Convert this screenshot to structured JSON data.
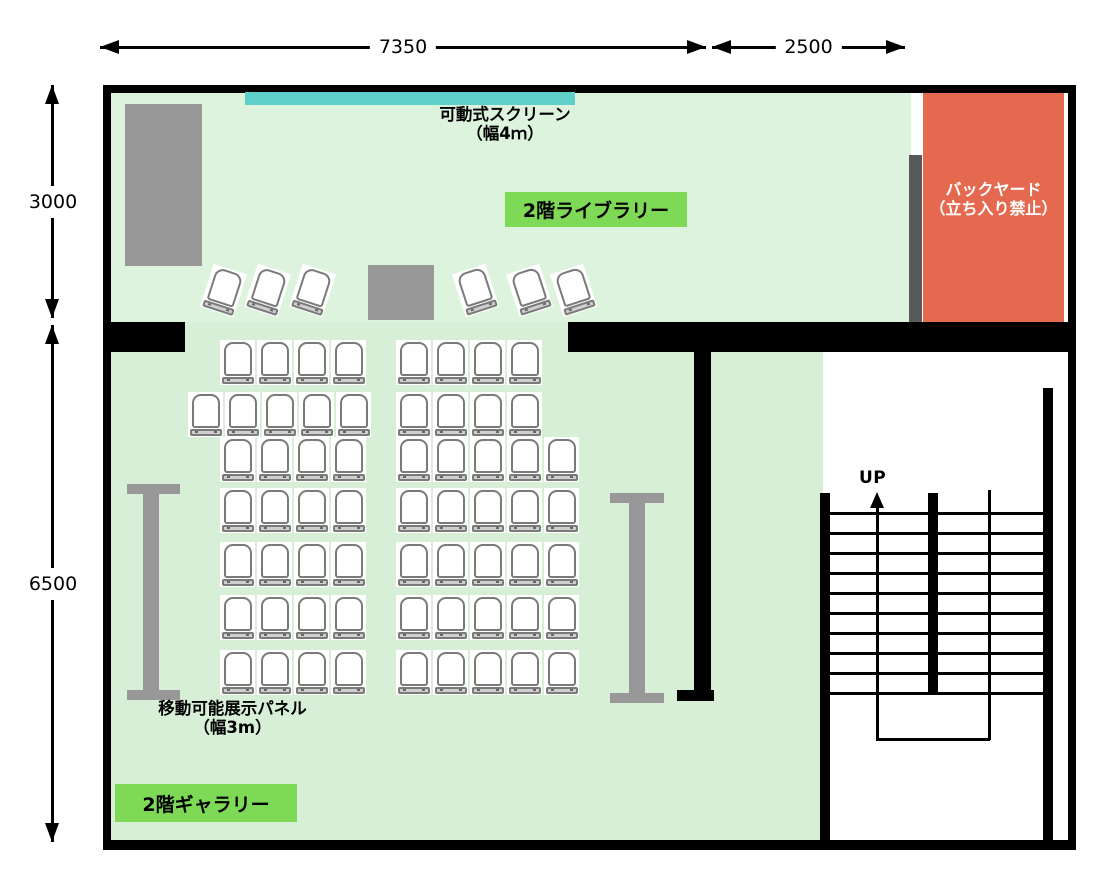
{
  "dimensions": {
    "horizontal": [
      {
        "label": "7350",
        "x1": 100,
        "x2": 706,
        "y": 47
      },
      {
        "label": "2500",
        "x1": 712,
        "x2": 905,
        "y": 47
      }
    ],
    "vertical": [
      {
        "label": "3000",
        "x": 52,
        "y1": 85,
        "y2": 318
      },
      {
        "label": "6500",
        "x": 52,
        "y1": 325,
        "y2": 842
      }
    ]
  },
  "rooms": {
    "library": {
      "label": "2階ライブラリー"
    },
    "gallery": {
      "label": "2階ギャラリー"
    },
    "backyard": {
      "label_line1": "バックヤード",
      "label_line2": "（立ち入り禁止）"
    }
  },
  "equipment": {
    "screen": {
      "label_line1": "可動式スクリーン",
      "label_line2": "（幅4ｍ）"
    },
    "panel": {
      "label_line1": "移動可能展示パネル",
      "label_line2": "（幅3m）"
    },
    "stairs": {
      "up_label": "UP",
      "tread_count": 10
    }
  },
  "colors": {
    "floor_library": "#ddf3dd",
    "floor_gallery": "#d7eed7",
    "label_bg": "#7ed957",
    "screen": "#5fd0c9",
    "backyard": "#e5694f",
    "furniture_gray": "#989898",
    "backyard_wall_gray": "#595959"
  },
  "seating": {
    "chair_pitch": 37,
    "angled_left": {
      "y": 268,
      "x_list": [
        206,
        250,
        295
      ],
      "rotation_deg": 18
    },
    "angled_right": {
      "y": 268,
      "x_list": [
        458,
        512,
        556
      ],
      "rotation_deg": -18
    },
    "rows": [
      {
        "y": 340,
        "groups": [
          {
            "x": 220,
            "count": 4
          },
          {
            "x": 396,
            "count": 4
          }
        ]
      },
      {
        "y": 392,
        "groups": [
          {
            "x": 188,
            "count": 5
          },
          {
            "x": 396,
            "count": 4
          }
        ]
      },
      {
        "y": 437,
        "groups": [
          {
            "x": 220,
            "count": 4
          },
          {
            "x": 396,
            "count": 5
          }
        ]
      },
      {
        "y": 488,
        "groups": [
          {
            "x": 220,
            "count": 4
          },
          {
            "x": 396,
            "count": 5
          }
        ]
      },
      {
        "y": 542,
        "groups": [
          {
            "x": 220,
            "count": 4
          },
          {
            "x": 396,
            "count": 5
          }
        ]
      },
      {
        "y": 595,
        "groups": [
          {
            "x": 220,
            "count": 4
          },
          {
            "x": 396,
            "count": 5
          }
        ]
      },
      {
        "y": 650,
        "groups": [
          {
            "x": 220,
            "count": 4
          },
          {
            "x": 396,
            "count": 5
          }
        ]
      }
    ]
  }
}
